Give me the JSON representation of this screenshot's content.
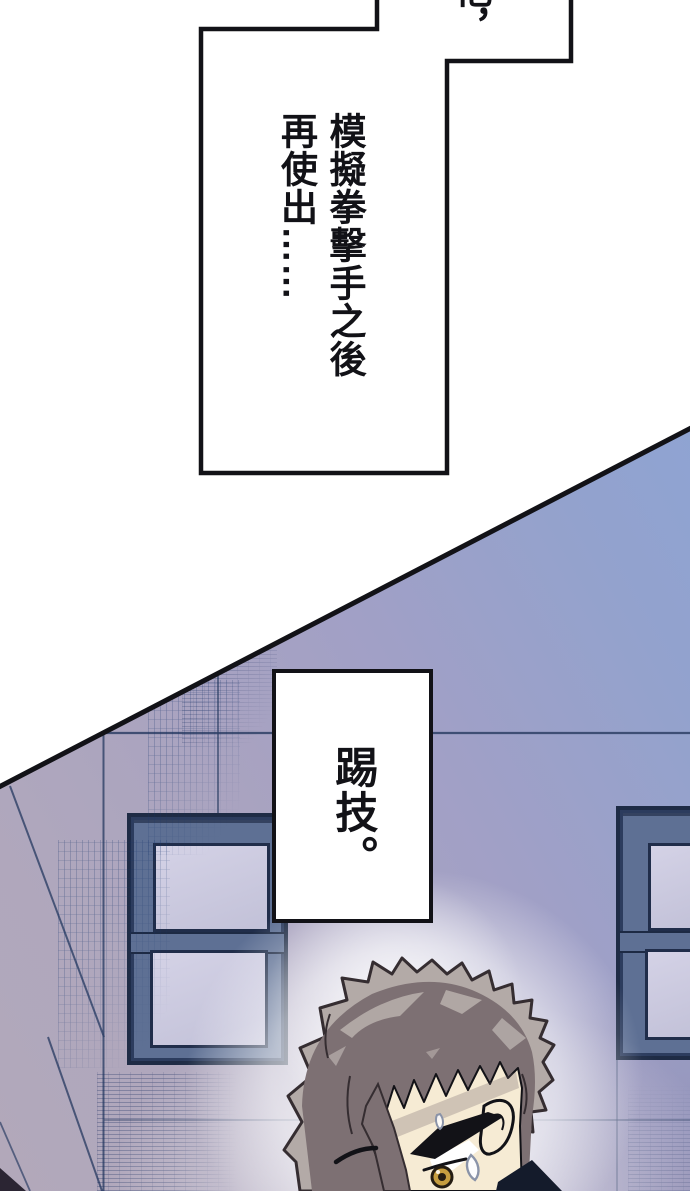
{
  "page": {
    "width": 690,
    "height": 1191,
    "background": "#ffffff"
  },
  "speech": {
    "top_overflow_bubble": {
      "fragment_text": "他，"
    },
    "narration_bubble": {
      "line1": "模擬拳擊手之後",
      "line2": "再使出",
      "ellipsis": "……"
    },
    "kick_bubble": {
      "text": "踢技。"
    }
  },
  "colors": {
    "page_bg": "#ffffff",
    "ink": "#121217",
    "sky": "#8ba5d8",
    "wall_mid": "#a3a0c4",
    "wall_low": "#b2a8ba",
    "pane": "#cbc9e0",
    "frame_slate": "#5e7094",
    "frame_dark": "#1e2b45",
    "thin_line": "#2e4066",
    "hatch": "#19345e",
    "corner_dark": "#2b2533",
    "hair_light": "#b3aaa7",
    "hair_base": "#7d7073",
    "hair_dark": "#352d31",
    "skin": "#f6ebd4",
    "iris": "#c69d3f",
    "collar": "#141b2b",
    "sweat": "#8a93a8"
  }
}
